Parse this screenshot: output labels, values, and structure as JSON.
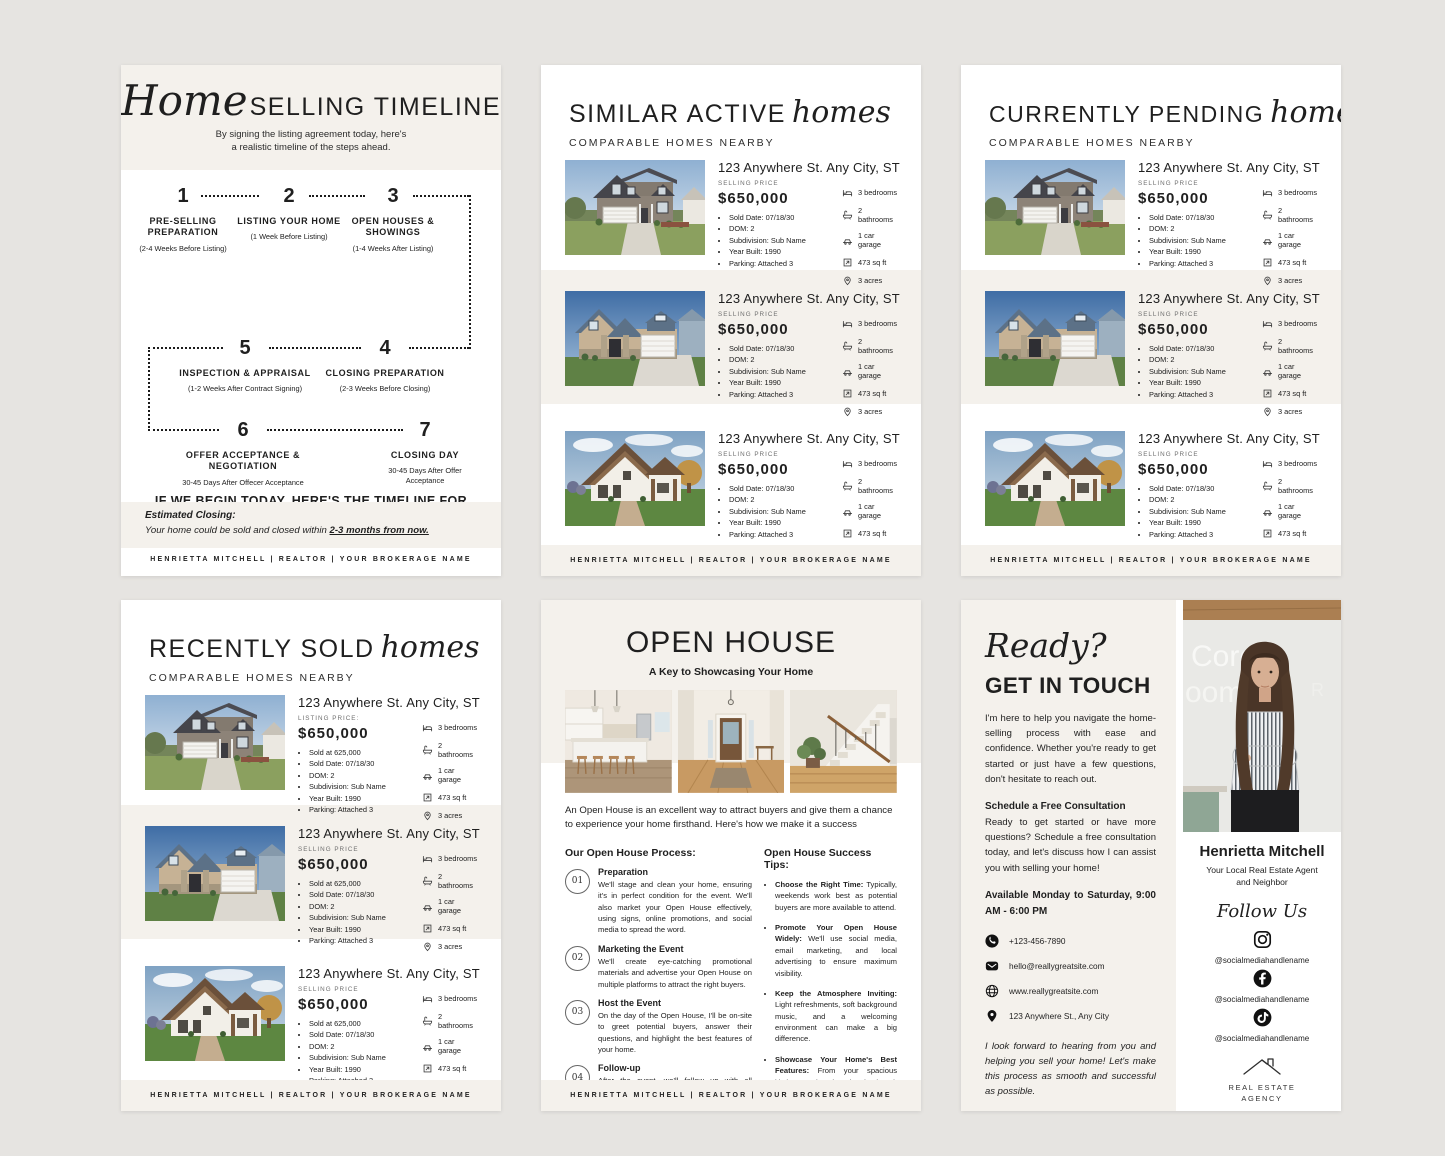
{
  "brand": {
    "canvas_bg": "#e6e4e1",
    "page_bg": "#ffffff",
    "cream_band": "#f4f1ec",
    "text_dark": "#1f1f1f",
    "text_gray": "#6e6e6e"
  },
  "footer_text": "HENRIETTA MITCHELL | REALTOR | YOUR BROKERAGE NAME",
  "listing_attrs": [
    {
      "icon": "bed-icon",
      "label": "3 bedrooms"
    },
    {
      "icon": "bath-icon",
      "label": "2 bathrooms"
    },
    {
      "icon": "car-icon",
      "label": "1  car garage"
    },
    {
      "icon": "area-icon",
      "label": "473 sq ft"
    },
    {
      "icon": "acres-icon",
      "label": "3 acres"
    }
  ],
  "pages": {
    "timeline": {
      "title_script": "Home",
      "title_main": "SELLING TIMELINE",
      "subtitle_line1": "By signing the listing agreement today, here's",
      "subtitle_line2": "a realistic timeline of the steps ahead.",
      "steps": [
        {
          "num": "1",
          "title": "PRE-SELLING PREPARATION",
          "sub": "(2-4 Weeks Before Listing)"
        },
        {
          "num": "2",
          "title": "LISTING YOUR HOME",
          "sub": "(1 Week Before Listing)"
        },
        {
          "num": "3",
          "title": "OPEN HOUSES & SHOWINGS",
          "sub": "(1-4 Weeks After Listing)"
        },
        {
          "num": "5",
          "title": "INSPECTION & APPRAISAL",
          "sub": "(1-2 Weeks After Contract Signing)"
        },
        {
          "num": "4",
          "title": "CLOSING PREPARATION",
          "sub": "(2-3 Weeks Before Closing)"
        },
        {
          "num": "6",
          "title": "OFFER ACCEPTANCE & NEGOTIATION",
          "sub": "30-45 Days After Offecer Acceptance"
        },
        {
          "num": "7",
          "title": "CLOSING DAY",
          "sub": "30-45 Days After Offer Acceptance"
        }
      ],
      "begin_heading": "IF WE BEGIN TODAY, HERE'S THE TIMELINE FOR LISTING YOUR HOME....",
      "p1_bold": "Listing Your Home:",
      "p1_rest": " We can have it actively on the market within 1-2 weeks.",
      "p2_bold": "Potential Sale Timeline:",
      "p2_rest": " Considering current market conditions, we could have an accepted offer within 2-4 weeks of listing.",
      "closing_heading": "Estimated Closing:",
      "closing_text": "Your home could be sold and closed within ",
      "closing_underlined": "2-3 months from now."
    },
    "similar_active": {
      "title_main": "SIMILAR ACTIVE",
      "title_script": "homes",
      "subtitle": "COMPARABLE HOMES NEARBY",
      "cards": [
        {
          "photo_icon": "#house-gray-photo",
          "address": "123 Anywhere St. Any City, ST",
          "price_label": "SELLING PRICE",
          "price": "$650,000",
          "bullets": [
            "Sold Date: 07/18/30",
            "DOM: 2",
            "Subdivision: Sub Name",
            "Year Built: 1990",
            "Parking: Attached 3"
          ]
        },
        {
          "photo_icon": "#house-craftsman-photo",
          "address": "123 Anywhere St. Any City, ST",
          "price_label": "SELLING PRICE",
          "price": "$650,000",
          "bullets": [
            "Sold Date: 07/18/30",
            "DOM: 2",
            "Subdivision: Sub Name",
            "Year Built: 1990",
            "Parking: Attached 3"
          ]
        },
        {
          "photo_icon": "#house-chalet-photo",
          "address": "123 Anywhere St. Any City, ST",
          "price_label": "SELLING PRICE",
          "price": "$650,000",
          "bullets": [
            "Sold Date: 07/18/30",
            "DOM: 2",
            "Subdivision: Sub Name",
            "Year Built: 1990",
            "Parking: Attached 3"
          ]
        }
      ]
    },
    "currently_pending": {
      "title_main": "CURRENTLY PENDING",
      "title_script": "homes",
      "subtitle": "COMPARABLE HOMES NEARBY",
      "cards": [
        {
          "photo_icon": "#house-gray-photo",
          "address": "123 Anywhere St. Any City, ST",
          "price_label": "SELLING PRICE",
          "price": "$650,000",
          "bullets": [
            "Sold Date: 07/18/30",
            "DOM: 2",
            "Subdivision: Sub Name",
            "Year Built: 1990",
            "Parking: Attached 3"
          ]
        },
        {
          "photo_icon": "#house-craftsman-photo",
          "address": "123 Anywhere St. Any City, ST",
          "price_label": "SELLING PRICE",
          "price": "$650,000",
          "bullets": [
            "Sold Date: 07/18/30",
            "DOM: 2",
            "Subdivision: Sub Name",
            "Year Built: 1990",
            "Parking: Attached 3"
          ]
        },
        {
          "photo_icon": "#house-chalet-photo",
          "address": "123 Anywhere St. Any City, ST",
          "price_label": "SELLING PRICE",
          "price": "$650,000",
          "bullets": [
            "Sold Date: 07/18/30",
            "DOM: 2",
            "Subdivision: Sub Name",
            "Year Built: 1990",
            "Parking: Attached 3"
          ]
        }
      ]
    },
    "recently_sold": {
      "title_main": "RECENTLY SOLD",
      "title_script": "homes",
      "subtitle": "COMPARABLE HOMES NEARBY",
      "cards": [
        {
          "photo_icon": "#house-gray-photo",
          "address": "123 Anywhere St. Any City, ST",
          "price_label": "LISTING PRICE:",
          "price": "$650,000",
          "bullets": [
            "Sold at 625,000",
            "Sold Date: 07/18/30",
            "DOM: 2",
            "Subdivision: Sub Name",
            "Year Built: 1990",
            "Parking: Attached 3"
          ]
        },
        {
          "photo_icon": "#house-craftsman-photo",
          "address": "123 Anywhere St. Any City, ST",
          "price_label": "SELLING PRICE",
          "price": "$650,000",
          "bullets": [
            "Sold at 625,000",
            "Sold Date: 07/18/30",
            "DOM: 2",
            "Subdivision: Sub Name",
            "Year Built: 1990",
            "Parking: Attached 3"
          ]
        },
        {
          "photo_icon": "#house-chalet-photo",
          "address": "123 Anywhere St. Any City, ST",
          "price_label": "SELLING PRICE",
          "price": "$650,000",
          "bullets": [
            "Sold at 625,000",
            "Sold Date: 07/18/30",
            "DOM: 2",
            "Subdivision: Sub Name",
            "Year Built: 1990",
            "Parking: Attached 3"
          ]
        }
      ]
    },
    "open_house": {
      "title": "OPEN HOUSE",
      "subtitle": "A Key to Showcasing Your Home",
      "photos": [
        {
          "icon": "#photo-kitchen"
        },
        {
          "icon": "#photo-entry"
        },
        {
          "icon": "#photo-stairs"
        }
      ],
      "intro": "An Open House is an excellent way to attract buyers and give them a chance to experience your home firsthand. Here's how we make it a success",
      "process_heading": "Our Open House Process:",
      "process": [
        {
          "num": "01",
          "title": "Preparation",
          "text": "We'll stage and clean your home, ensuring it's in perfect condition for the event. We'll also market your Open House effectively, using signs, online promotions, and social media to spread the word."
        },
        {
          "num": "02",
          "title": "Marketing the Event",
          "text": "We'll create eye-catching promotional materials and advertise your Open House on multiple platforms to attract the right buyers."
        },
        {
          "num": "03",
          "title": "Host the Event",
          "text": "On the day of the Open House, I'll be on-site to greet potential buyers, answer their questions, and highlight the best features of your home."
        },
        {
          "num": "04",
          "title": "Follow-up",
          "text": "After the event, we'll follow up with all attendees, gather feedback, and gauge their level of interest in the property."
        }
      ],
      "tips_heading": "Open House Success Tips:",
      "tips": [
        {
          "bold": "Choose the Right Time:",
          "rest": " Typically, weekends work best as potential buyers are more available to attend."
        },
        {
          "bold": "Promote Your Open House Widely:",
          "rest": " We'll use social media, email marketing, and local advertising to ensure maximum visibility."
        },
        {
          "bold": "Keep the Atmosphere Inviting:",
          "rest": " Light refreshments, soft background music, and a welcoming environment can make a big difference."
        },
        {
          "bold": "Showcase Your Home's Best Features:",
          "rest": " From your spacious kitchen to the charming backyard, we'll ensure buyers see what makes your home special."
        }
      ]
    },
    "get_in_touch": {
      "script": "Ready?",
      "title": "GET IN TOUCH",
      "intro": "I'm here to help you navigate the home-selling process with ease and confidence. Whether you're ready to get started or just have a few questions, don't hesitate to reach out.",
      "consult_heading": "Schedule a Free Consultation",
      "consult_text": "Ready to get started or have more questions? Schedule a free consultation today, and let's discuss how I can assist you with selling your home!",
      "availability": "Available Monday to Saturday, 9:00 AM - 6:00 PM",
      "contacts": [
        {
          "icon": "phone-icon",
          "value": "+123-456-7890"
        },
        {
          "icon": "email-icon",
          "value": "hello@reallygreatsite.com"
        },
        {
          "icon": "globe-icon",
          "value": "www.reallygreatsite.com"
        },
        {
          "icon": "location-icon",
          "value": "123 Anywhere St., Any City"
        }
      ],
      "closing_note": "I look forward to hearing from you and helping you sell your home! Let's make this process as smooth and successful as possible.",
      "agent_photo_icon": "#agent-photo",
      "agent_name": "Henrietta Mitchell",
      "agent_role_line1": "Your Local Real Estate Agent",
      "agent_role_line2": "and Neighbor",
      "follow_script": "Follow Us",
      "socials": [
        {
          "icon": "instagram-icon",
          "handle": "@socialmediahandlename"
        },
        {
          "icon": "facebook-icon",
          "handle": "@socialmediahandlename"
        },
        {
          "icon": "tiktok-icon",
          "handle": "@socialmediahandlename"
        }
      ],
      "agency_line1": "REAL ESTATE",
      "agency_line2": "AGENCY"
    }
  }
}
